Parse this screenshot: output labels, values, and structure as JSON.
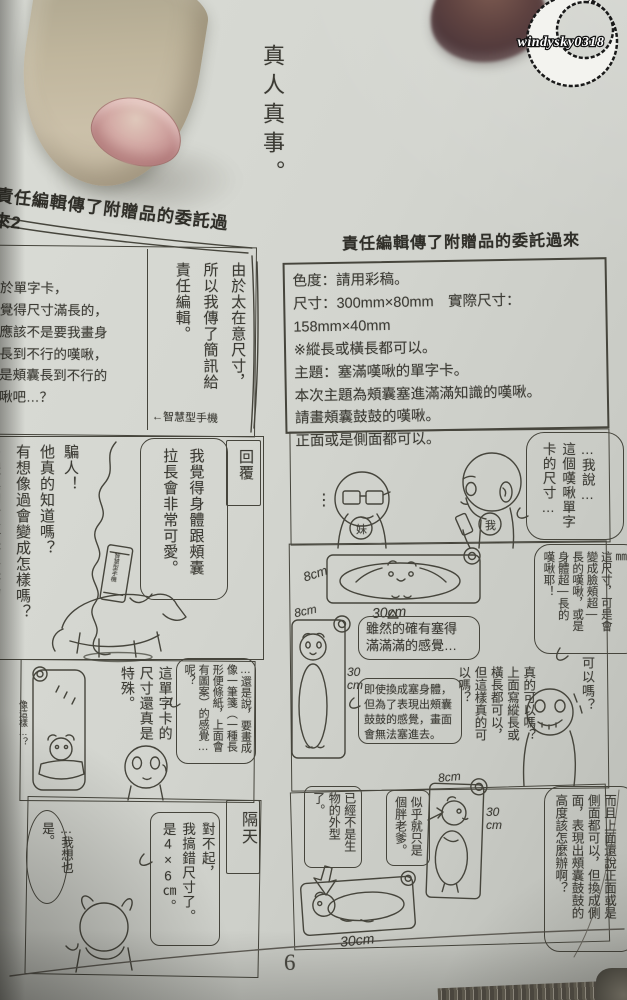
{
  "watermark": {
    "text": "windysky0318"
  },
  "page": {
    "tagline": "真人真事。",
    "number": "6"
  },
  "left": {
    "header": "責任編輯傳了附贈品的委託過來2",
    "p1": {
      "paragraph": "關於單字卡，\n我覺得尺寸滿長的，\n但應該不是要我畫身\n體長到不行的嘆啾，\n而是頰囊長到不行的\n嘆啾吧…？",
      "speech": "由於太在意尺寸，\n所以我傳了簡訊給\n責任編輯。",
      "note": "←智慧型手機"
    },
    "p2": {
      "label": "回覆",
      "speech": "我覺得身體跟頰囊\n拉長會非常可愛。",
      "thought": "騙人！\n他真的知道嗎？\n有想像過會變成怎樣嗎？",
      "thought_clipped": "身體真的會拉長很長嗎",
      "phone": "智慧型手機"
    },
    "p3": {
      "speech1": "…還是說，要畫成像一筆箋（一種長形便條紙，上面會有圖案）的感覺…呢？",
      "speech2": "這單字卡的\n尺寸還真是\n特殊。",
      "aside": "像這樣…？"
    },
    "p4": {
      "label": "隔天",
      "speech1": "對不起，\n我搞錯尺寸了。\n是4×6㎝。",
      "speech2": "…我想也是。"
    }
  },
  "right": {
    "header": "責任編輯傳了附贈品的委託過來",
    "spec": {
      "lines": [
        "色度：請用彩稿。",
        "尺寸：300mm×80mm　實際尺寸：158mm×40mm",
        "※縱長或橫長都可以。",
        "主題：塞滿嘆啾的單字卡。",
        "本次主題為頰囊塞進滿滿知識的嘆啾。",
        "請畫頰囊鼓鼓的嘆啾。",
        "正面或是側面都可以。"
      ]
    },
    "p1": {
      "speech": "…我說…\n這個嘆啾單字\n卡的尺寸…",
      "tag_sister": "妹",
      "tag_me": "我",
      "dots": "⋮"
    },
    "p2": {
      "speech": "300㎜×80㎜\n這尺寸，可是會\n變成臉頰超—\n長的嘆啾，或是\n身體超—長的\n嘆啾耶！",
      "hcard_h": "8cm",
      "hcard_w": "30cm",
      "vcard_w": "8cm",
      "vcard_h": "30\ncm",
      "bubble1": "雖然的確有塞得\n滿滿滿的感覺…",
      "bubble2": "即使換成塞身體，\n但為了表現出頰囊\n鼓鼓的感覺，畫面\n會無法塞進去。",
      "thought": "真的可以嗎？\n上面寫縱長或\n橫長都可以，\n但這樣真的可\n以嗎？",
      "aside": "可以嗎？"
    },
    "p3": {
      "speech": "而且上面還說正面或是\n側面都可以，但換成側\n面，表現出頰囊鼓鼓的\n高度該怎麼辦啊？",
      "bubble1": "似乎就只是\n個胖老爹。",
      "bubble2": "已經不是生物的外型了。",
      "standing_w": "8cm",
      "standing_h": "30\ncm",
      "lying_w": "30cm"
    }
  }
}
